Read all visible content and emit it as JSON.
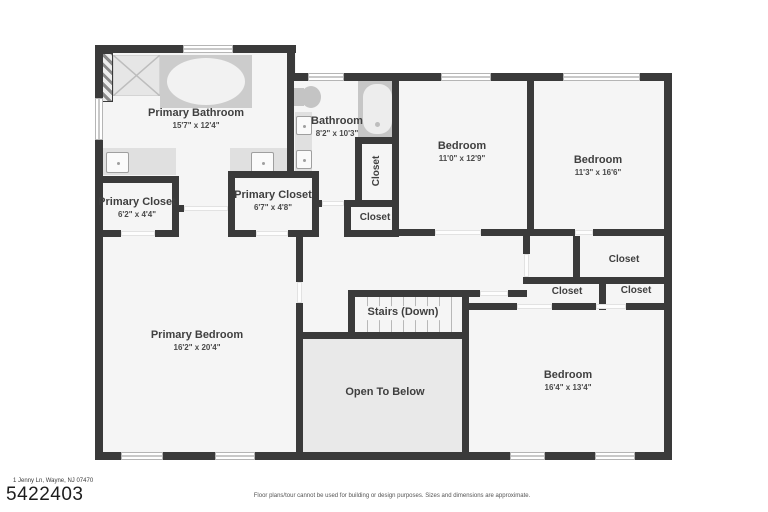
{
  "rooms": {
    "primary_bathroom": {
      "name": "Primary Bathroom",
      "dims": "15'7\" x 12'4\""
    },
    "bathroom": {
      "name": "Bathroom",
      "dims": "8'2\" x 10'3\""
    },
    "bedroom_top_middle": {
      "name": "Bedroom",
      "dims": "11'0\" x 12'9\""
    },
    "bedroom_top_right": {
      "name": "Bedroom",
      "dims": "11'3\" x 16'6\""
    },
    "primary_closet_left": {
      "name": "Primary Closet",
      "dims": "6'2\" x 4'4\""
    },
    "primary_closet_right": {
      "name": "Primary Closet",
      "dims": "6'7\" x 4'8\""
    },
    "primary_bedroom": {
      "name": "Primary Bedroom",
      "dims": "16'2\" x 20'4\""
    },
    "bedroom_bottom_right": {
      "name": "Bedroom",
      "dims": "16'4\" x 13'4\""
    },
    "stairs": {
      "name": "Stairs (Down)"
    },
    "open_to_below": {
      "name": "Open To Below"
    },
    "closet_vertical": {
      "name": "Closet"
    },
    "closet_small": {
      "name": "Closet"
    },
    "closet_right_top": {
      "name": "Closet"
    },
    "closet_right_mid_left": {
      "name": "Closet"
    },
    "closet_right_mid_right": {
      "name": "Closet"
    }
  },
  "colors": {
    "wall": "#3a3a3a",
    "room_fill": "#f5f5f5",
    "open_to_below_fill": "#e9e9e9"
  },
  "footer": {
    "address": "1 Jenny Ln, Wayne, NJ 07470",
    "listing_number": "5422403",
    "disclaimer": "Floor plans/tour cannot be used for building or design purposes. Sizes and dimensions are approximate."
  }
}
